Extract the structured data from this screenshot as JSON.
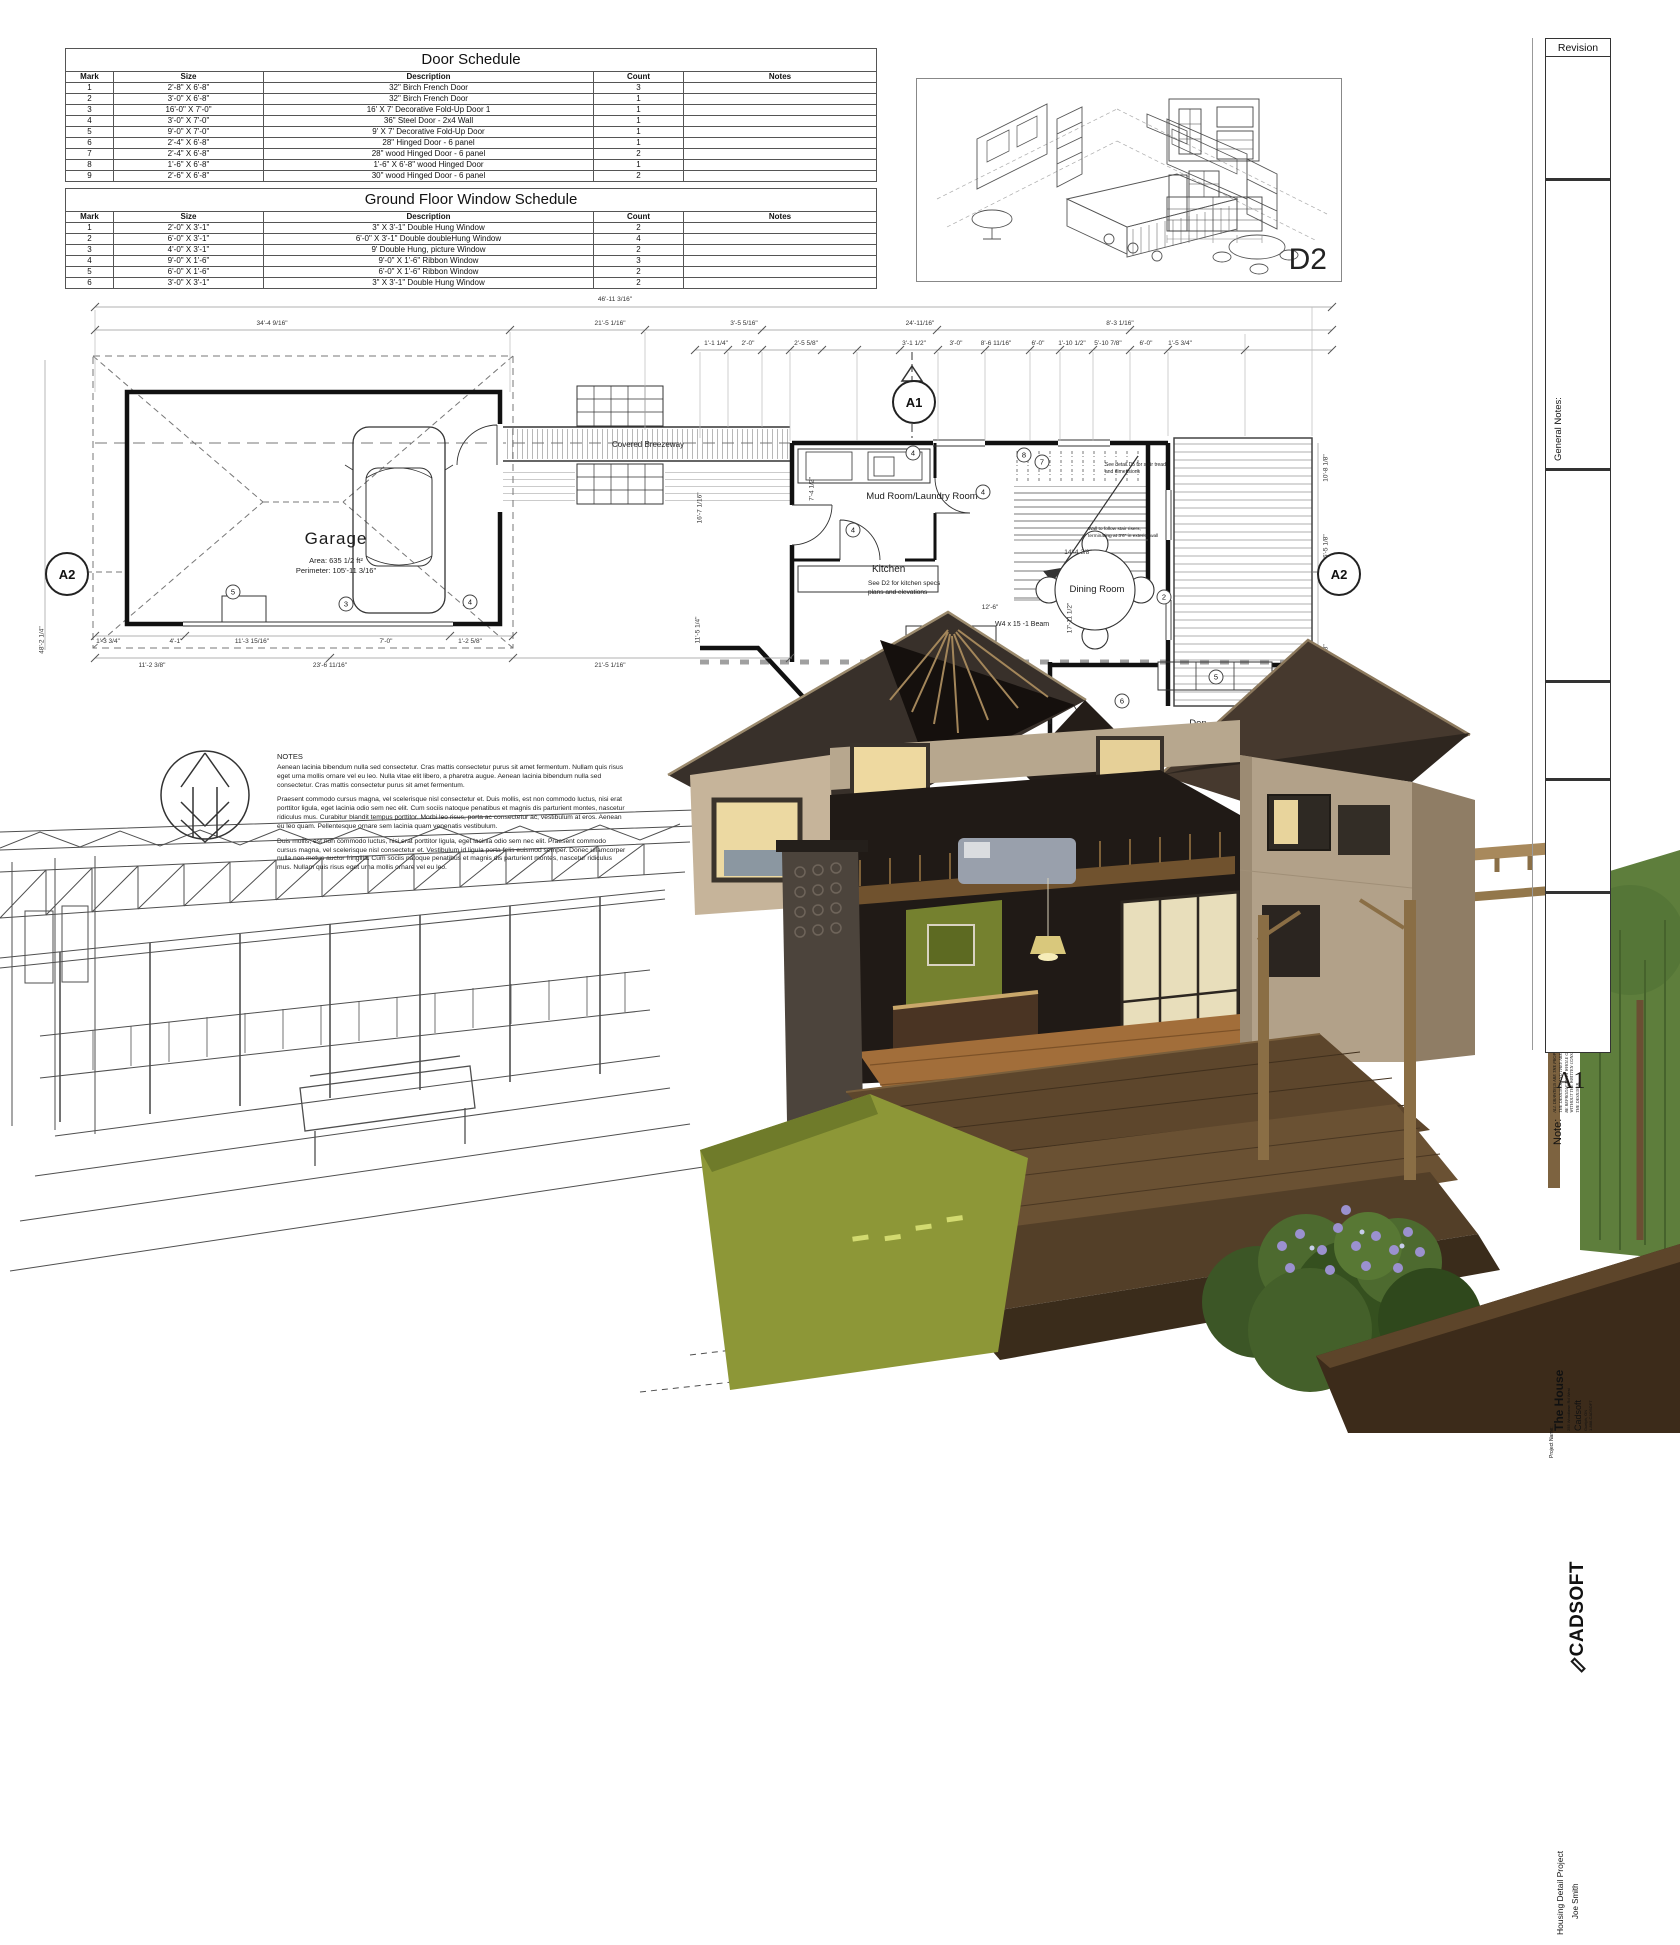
{
  "sheet": {
    "number": "A1"
  },
  "door_schedule": {
    "title": "Door Schedule",
    "columns": [
      "Mark",
      "Size",
      "Description",
      "Count",
      "Notes"
    ],
    "rows": [
      [
        "1",
        "2'-8\" X 6'-8\"",
        "32\" Birch French Door",
        "3",
        ""
      ],
      [
        "2",
        "3'-0\" X 6'-8\"",
        "32\" Birch French Door",
        "1",
        ""
      ],
      [
        "3",
        "16'-0\" X 7'-0\"",
        "16' X 7' Decorative Fold-Up Door 1",
        "1",
        ""
      ],
      [
        "4",
        "3'-0\" X 7'-0\"",
        "36\" Steel Door - 2x4 Wall",
        "1",
        ""
      ],
      [
        "5",
        "9'-0\" X 7'-0\"",
        "9' X 7' Decorative Fold-Up Door",
        "1",
        ""
      ],
      [
        "6",
        "2'-4\" X 6'-8\"",
        "28\" Hinged Door - 6 panel",
        "1",
        ""
      ],
      [
        "7",
        "2'-4\" X 6'-8\"",
        "28\" wood Hinged Door - 6 panel",
        "2",
        ""
      ],
      [
        "8",
        "1'-6\" X 6'-8\"",
        "1'-6\" X 6'-8\" wood Hinged Door",
        "1",
        ""
      ],
      [
        "9",
        "2'-6\" X 6'-8\"",
        "30\" wood Hinged Door - 6 panel",
        "2",
        ""
      ]
    ]
  },
  "window_schedule": {
    "title": "Ground Floor Window Schedule",
    "columns": [
      "Mark",
      "Size",
      "Description",
      "Count",
      "Notes"
    ],
    "rows": [
      [
        "1",
        "2'-0\" X 3'-1\"",
        "3\" X 3'-1\" Double Hung Window",
        "2",
        ""
      ],
      [
        "2",
        "6'-0\" X 3'-1\"",
        "6'-0\" X 3'-1\" Double doubleHung Window",
        "4",
        ""
      ],
      [
        "3",
        "4'-0\" X 3'-1\"",
        "9'  Double Hung, picture Window",
        "2",
        ""
      ],
      [
        "4",
        "9'-0\" X 1'-6\"",
        "9'-0\" X 1'-6\" Ribbon Window",
        "3",
        ""
      ],
      [
        "5",
        "6'-0\" X 1'-6\"",
        "6'-0\" X 1'-6\" Ribbon Window",
        "2",
        ""
      ],
      [
        "6",
        "3'-0\" X 3'-1\"",
        "3\" X 3'-1\" Double Hung Window",
        "2",
        ""
      ]
    ]
  },
  "detail_d2": {
    "label": "D2"
  },
  "markers": {
    "a1": "A1",
    "a2_left": "A2",
    "a2_right": "A2"
  },
  "plan_labels": {
    "garage": "Garage",
    "garage_area": "Area: 635 1/2 ft²",
    "garage_perimeter": "Perimeter: 105'-11 3/16\"",
    "breezeway": "Covered Breezeway",
    "mud_room": "Mud Room/Laundry Room",
    "kitchen": "Kitchen",
    "kitchen_note_1": "See D2 for kitchen specs",
    "kitchen_note_2": "plans and elevations",
    "dining": "Dining Room",
    "den": "Den",
    "nook": "Breakfast Nook",
    "beam": "W4 x 15 -1 Beam",
    "stair_note_1": "See detail D5 for stair tread",
    "stair_note_2": "and dimensions",
    "wall_note_1": "Wall to follow stair risers,",
    "wall_note_2": "terminating at 3'6\" in exterior wall"
  },
  "dims": {
    "d1": "46'-11 3/16\"",
    "d2": "34'-4 9/16\"",
    "d3": "21'-5 1/16\"",
    "d4": "3'-5 5/16\"",
    "d5": "24'-11/16\"",
    "d6": "8'-3 1/16\"",
    "d7": "1'-1 1/4\"",
    "d8": "2'-0\"",
    "d9": "2'-5 5/8\"",
    "d10": "3'-1 1/2\"",
    "d11": "3'-0\"",
    "d12": "8'-6 11/16\"",
    "d13": "6'-0\"",
    "d14": "1'-10 1/2\"",
    "d15": "5'-10 7/8\"",
    "d16": "6'-0\"",
    "d17": "1'-5 3/4\"",
    "d18": "10'-8 1/8\"",
    "d19": "16'-5 1/8\"",
    "d20": "14'-6 1/8\"",
    "d21": "48'-2 1/4\"",
    "d22": "11'-2 3/8\"",
    "d23": "23'-6 11/16\"",
    "d24": "21'-5 1/16\"",
    "d25": "1'-3 3/4\"",
    "d26": "4'-1\"",
    "d27": "11'-3 15/16\"",
    "d28": "7'-0\"",
    "d29": "1'-2 5/8\"",
    "d30": "16'-7 1/16\"",
    "d31": "11'-5 1/4\"",
    "d32": "14'-4 3/8\"",
    "d33": "17'-11 1/2\"",
    "d34": "12'-6\"",
    "d35": "7'-4 1/2\""
  },
  "tags": {
    "t1": "4",
    "t2": "8",
    "t3": "7",
    "t4": "4",
    "t5": "4",
    "t6": "2",
    "t7": "5",
    "t8": "6",
    "t9": "4",
    "t10": "5",
    "t11": "3",
    "t12": "4"
  },
  "notes": {
    "heading": "NOTES",
    "p1": "Aenean lacinia bibendum nulla sed consectetur. Cras mattis consectetur purus sit amet fermentum. Nullam quis risus eget urna mollis ornare vel eu leo. Nulla vitae elit libero, a pharetra augue. Aenean lacinia bibendum nulla sed consectetur. Cras mattis consectetur purus sit amet fermentum.",
    "p2": "Praesent commodo cursus magna, vel scelerisque nisl consectetur et. Duis mollis, est non commodo luctus, nisi erat porttitor ligula, eget lacinia odio sem nec elit. Cum sociis natoque penatibus et magnis dis parturient montes, nascetur ridiculus mus. Curabitur blandit tempus porttitor. Morbi leo risus, porta ac consectetur ac, vestibulum at eros. Aenean eu leo quam. Pellentesque ornare sem lacinia quam venenatis vestibulum.",
    "p3": "Duis mollis, est non commodo luctus, nisi erat porttitor ligula, eget lacinia odio sem nec elit. Praesent commodo cursus magna, vel scelerisque nisl consectetur et. Vestibulum id ligula porta felis euismod semper. Donec ullamcorper nulla non metus auctor fringilla. Cum sociis natoque penatibus et magnis dis parturient montes, nascetur ridiculus mus. Nullam quis risus eget urna mollis ornare vel eu leo."
  },
  "title_block": {
    "revision": "Revision",
    "general_notes": "General Notes:",
    "note_heading": "Note:",
    "note_p1": "ALL DRAWINGS ARE THE PROPERTY OF THE DESIGNER AND THEY ARE NOT TO BE REPRODUCED IN WHOLE OR IN PART WITHOUT THE WRITTEN CONSENT OF THE DESIGNER.",
    "note_p2": "CONTRACTOR TO CHECK AND VERIFY ALL DIMENSIONS BEFORE COMMENCING WORK AND TO REPORT ANY DISCREPANCIES TO THE DESIGNER.",
    "project_name_label": "Project Name:",
    "project_name": "The House",
    "project_address": "255 Woodlawn Rd West",
    "company": "Cadsoft",
    "company_city": "Guelph, ON",
    "company_phone": "1-888-CADSOFT",
    "logo": "CADSOFT",
    "project_title": "Housing Detail Project",
    "author": "Joe Smith"
  },
  "colors": {
    "roof_dark": "#38302a",
    "wall_tan": "#b2a189",
    "deck_brown": "#5d462c",
    "lawn_green": "#8d9737",
    "bush_green": "#3c5626",
    "flower_purple": "#9b91cf"
  }
}
